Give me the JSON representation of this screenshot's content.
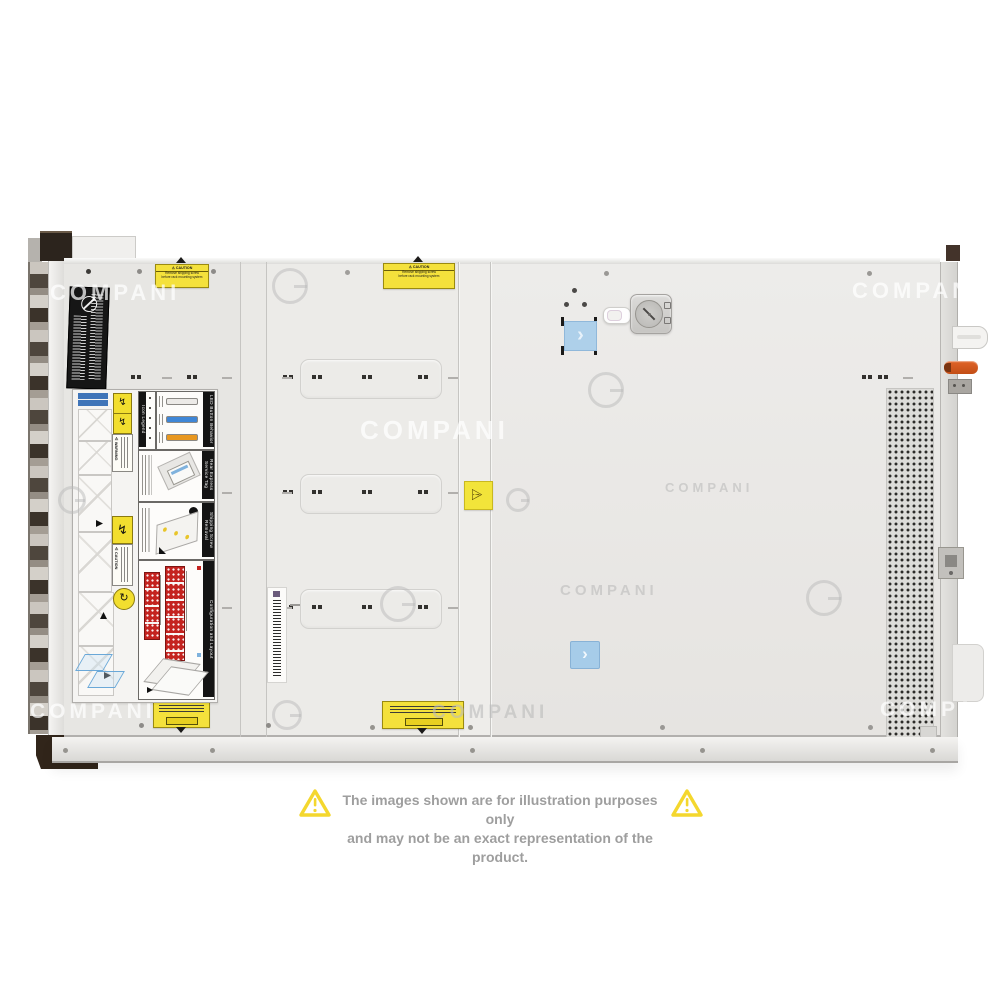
{
  "watermark": {
    "text": "COMPANI"
  },
  "disclaimer": {
    "line1": "The images shown are for illustration purposes only",
    "line2": "and may not be an exact representation of the product."
  },
  "labels": {
    "caution_top": {
      "title": "⚠ CAUTION",
      "line1": "Remove shipping screw",
      "line2": "before rack mounting system"
    },
    "service": {
      "warning": "⚠ WARNING",
      "caution": "⚠ CAUTION",
      "icon_legend": "Icon Legend",
      "led_button_behavior": "LED Button Behavior",
      "rear_express_service_tag": "Rear Express Service Tag",
      "shipping_screw_removal": "Shipping Screw Removal",
      "configuration_and_layout": "Configuration and Layout"
    }
  },
  "icons": {
    "chevron": "›",
    "warning_triangle": "⚠",
    "hazard_bolt": "↯",
    "rotate_arrow": "↻"
  },
  "colors": {
    "chassis": "#e9e8e6",
    "accent_blue": "#aed0ea",
    "caution_yellow": "#f4e13c",
    "lever_orange": "#d4581e",
    "bay_red": "#c4231f",
    "led_blue": "#3f86d6",
    "led_orange": "#e8971f",
    "watermark_gray": "#bababa",
    "disclaimer_gray": "#9e9e9e",
    "triangle_yellow": "#f4d72e"
  }
}
